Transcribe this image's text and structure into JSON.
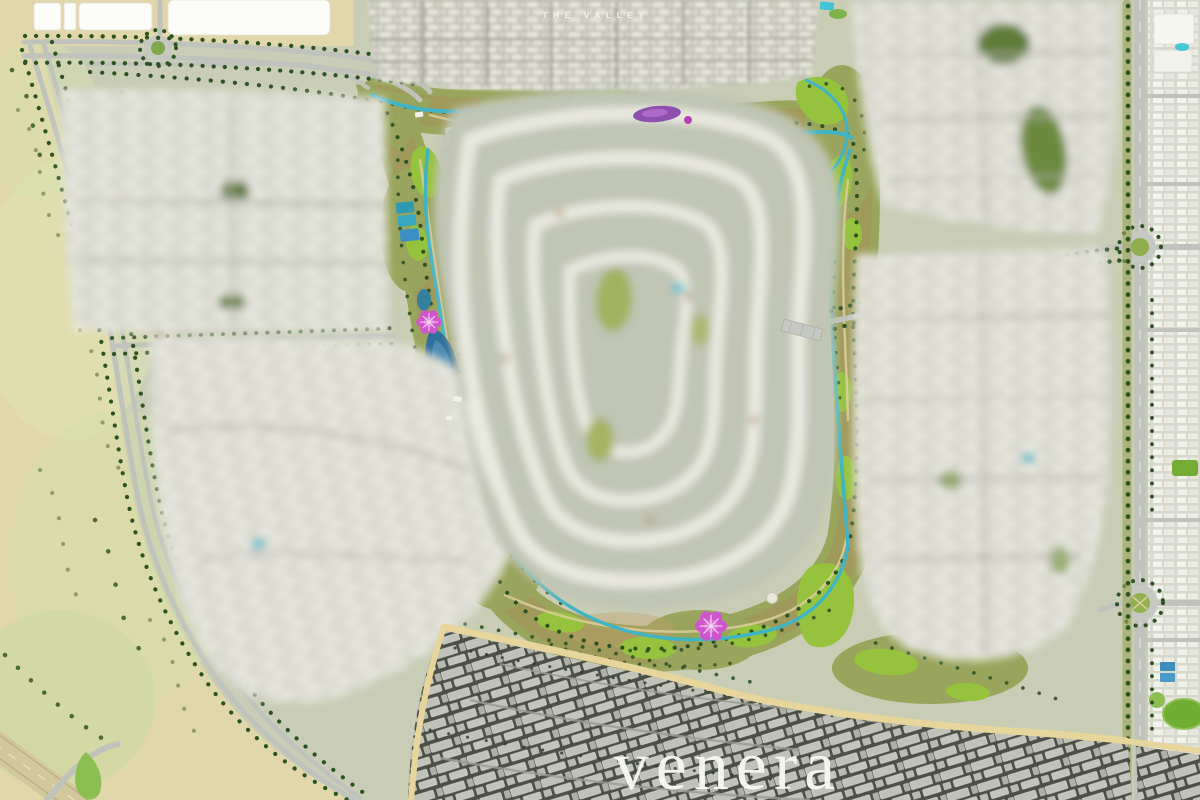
{
  "map": {
    "project": "venera",
    "labels": {
      "neighborhood": "THE VALLEY",
      "brand": "venera"
    },
    "colors": {
      "ground_sage": "#c9cdb5",
      "desert_sand": "#e2d7ab",
      "park_olive": "#99a45c",
      "scrub_brown": "#ab8d58",
      "lawn_green": "#96c33d",
      "tree_green": "#2d5222",
      "water_teal": "#3fb4c4",
      "lake_blue": "#2f6f9b",
      "pool_cyan": "#3fc3d6",
      "road_gray": "#c0c3bc",
      "sand_road": "#e7d59b",
      "house_white": "#f2f1e9",
      "dark_ground": "#4c4f46",
      "landmark_pink": "#cf55ce",
      "flowerbed_purple": "#8d50ae",
      "label_white": "#f8f8f3"
    },
    "features": [
      {
        "id": "the-valley-cluster",
        "label": "THE VALLEY",
        "kind": "row-house district, top center"
      },
      {
        "id": "central-loop-cluster",
        "kind": "blurred villa cluster with looping streets, center"
      },
      {
        "id": "left-upper-cluster",
        "kind": "blurred villa cluster, west"
      },
      {
        "id": "left-lower-cluster",
        "kind": "blurred villa cluster, southwest"
      },
      {
        "id": "top-right-cluster",
        "kind": "blurred villa cluster, northeast"
      },
      {
        "id": "right-cluster",
        "kind": "blurred villa cluster, east"
      },
      {
        "id": "dark-ground-village",
        "kind": "light roofs on dark ground, south district"
      },
      {
        "id": "green-valley-corridor",
        "kind": "park loop with streams, lake, lawns, sport courts, pools"
      },
      {
        "id": "pink-pavilions",
        "kind": "two flower-shaped landmark pavilions and purple flower bed"
      },
      {
        "id": "desert-belt",
        "kind": "open desert with curving perimeter road, west"
      },
      {
        "id": "east-avenue",
        "kind": "north-south arterial with two roundabouts"
      },
      {
        "id": "northwest-road",
        "kind": "avenue with small roundabout and white vacant parcels"
      },
      {
        "id": "east-city-strip",
        "kind": "existing city blocks, east edge"
      },
      {
        "id": "southwest-highway",
        "kind": "highway with slip road, bottom-left corner"
      }
    ],
    "roundabout_count": 3
  }
}
